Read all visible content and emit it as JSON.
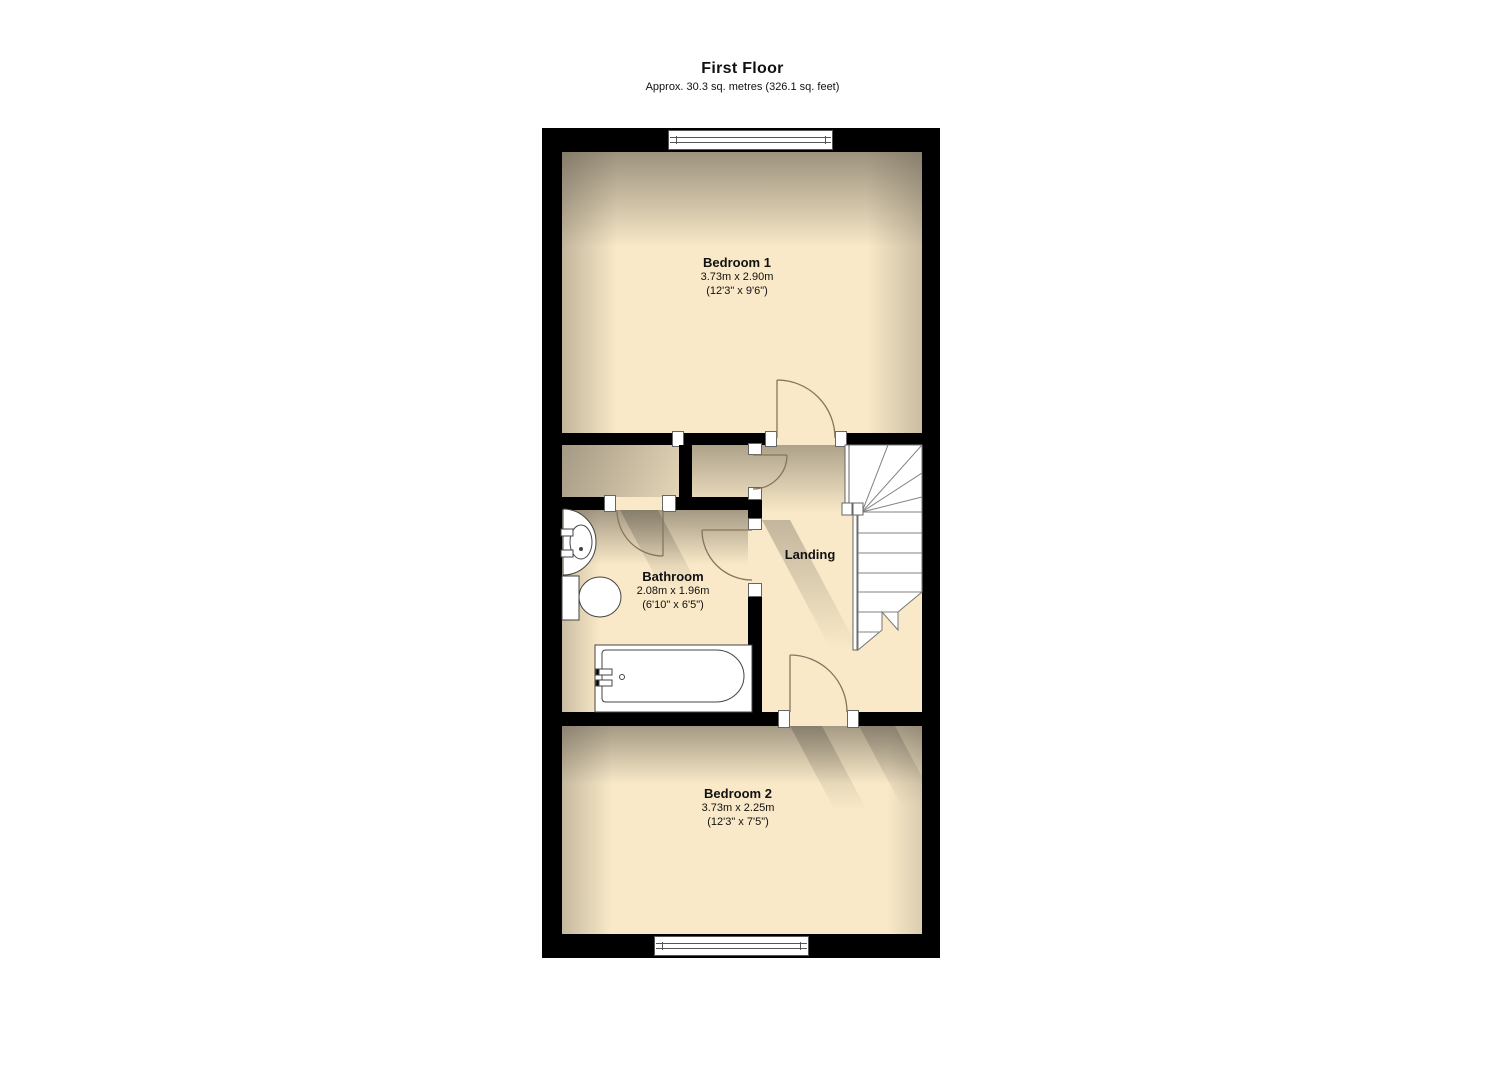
{
  "header": {
    "title": "First Floor",
    "subtitle": "Approx. 30.3 sq. metres (326.1 sq. feet)"
  },
  "rooms": {
    "bedroom1": {
      "name": "Bedroom 1",
      "metric": "3.73m x 2.90m",
      "imperial": "(12'3\" x 9'6\")"
    },
    "bathroom": {
      "name": "Bathroom",
      "metric": "2.08m x 1.96m",
      "imperial": "(6'10\" x 6'5\")"
    },
    "landing": {
      "name": "Landing"
    },
    "bedroom2": {
      "name": "Bedroom 2",
      "metric": "3.73m x 2.25m",
      "imperial": "(12'3\" x 7'5\")"
    }
  },
  "colors": {
    "wall": "#000000",
    "floor": "#f9e9c8",
    "background": "#ffffff",
    "stairs_fill": "#ffffff",
    "fixture_line": "#444444",
    "door_line": "#86755e",
    "stair_line": "#777777"
  }
}
